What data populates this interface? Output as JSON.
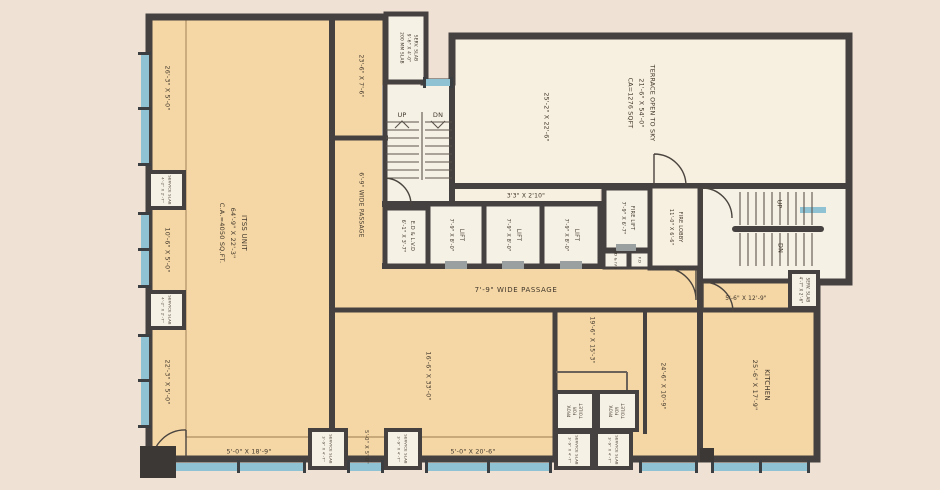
{
  "labels": {
    "itss1": "ITSS UNIT",
    "itss2": "64'-9\" X 22'-3\"",
    "itss3": "C.A.=4050 SQ.FT.",
    "terrace1": "TERRACE OPEN TO SKY",
    "terrace2": "21'-6\" X 54'-0\"",
    "terrace3": "CA=1276 SQFT",
    "terraceDim": "25'-2\" X 22'-6\"",
    "ductDim": "3'3\" X 2'10\"",
    "stripTopRight": "23'-6\" X 7'-6\"",
    "stripLeftTop": "26'-3\" X 5'-0\"",
    "stripLeftMid": "10'-6\" X 5'-0\"",
    "stripLeftBot": "22'-3\" X 5'-0\"",
    "stripBottomLeft": "5'-0\" X 18'-9\"",
    "stripBottomMid": "5'-0\" X 5'-0\"",
    "stripBottomRight": "5'-0\" X 20'-6\"",
    "passageH": "7'-9\" WIDE PASSAGE",
    "passageV": "6'-9\" WIDE PASSAGE",
    "lift": "LIFT",
    "liftDim": "7'-9\" X 8'-0\"",
    "fireLift1": "FIRE LIFT",
    "fireLift2": "7'-9\" X 6'-7\"",
    "fireLobby1": "FIRE LOBBY",
    "fireLobby2": "11'-0\" X 6'-6\"",
    "edLvd1": "E.D & L.V.D",
    "edLvd2": "6'-1\" X 3'-7\"",
    "edIvdSmall": "ED & IVD",
    "fdSmall": "F.D",
    "servSlabTop1": "SERV. SLAB",
    "servSlabTop2": "9'-6\" X 4'-0\"",
    "servSlabTop3": "200 MM SLAB",
    "serviceSlab": "SERVICE SLAB",
    "serviceSlabDimLeft": "4'-2\" X 2'-7\"",
    "serviceSlabDimBottom": "3'-9\" X 4'-7\"",
    "servSlabRight1": "SERV. SLAB",
    "servSlabRight2": "4'-7\" X 2'-6\"",
    "room16": "16'-6\" X 33'-0\"",
    "room19": "19'-6\" X 15'-3\"",
    "room24": "24'-6\" X 10'-9\"",
    "roomStairSide": "5'-6\" X 12'-9\"",
    "prov1": "PROV.",
    "prov2": "FOR",
    "prov3": "TOILET",
    "up": "UP",
    "dn": "DN"
  },
  "colors": {
    "background": "#efe1d4",
    "wall": "#454140",
    "roomTan": "#f5d7a5",
    "roomLight": "#f6f1e5",
    "terraceCream": "#f7efdf",
    "window": "#8fc3d4",
    "thinLine": "#b89a6d",
    "text": "#40362b"
  }
}
